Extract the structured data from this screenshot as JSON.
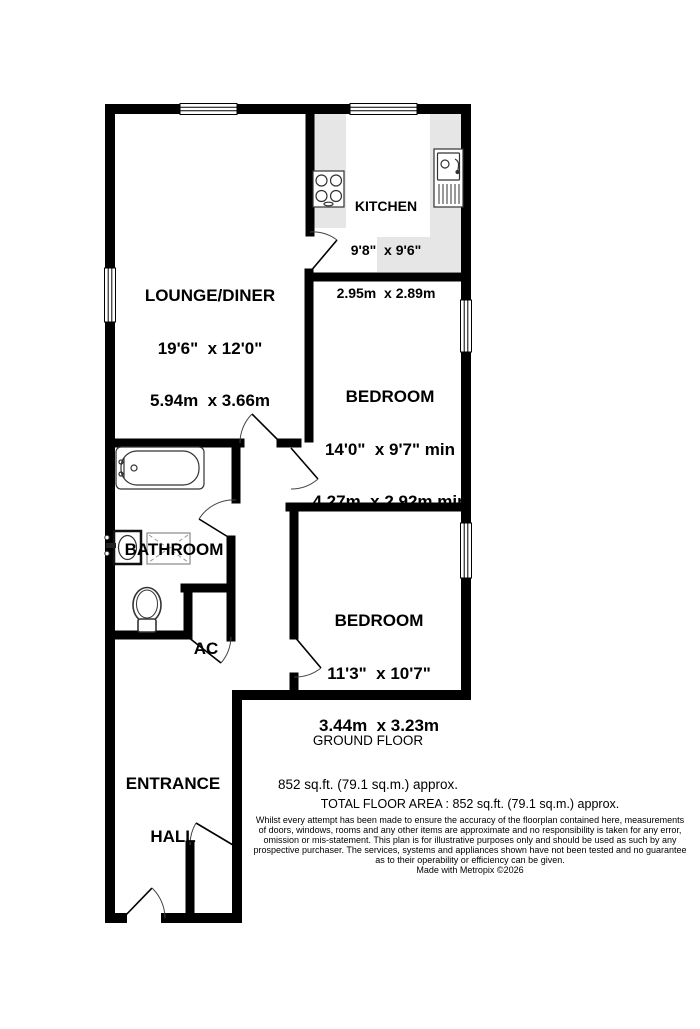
{
  "rooms": {
    "kitchen": {
      "name": "KITCHEN",
      "imperial": "9'8\"  x 9'6\"",
      "metric": "2.95m  x 2.89m"
    },
    "lounge_diner": {
      "name": "LOUNGE/DINER",
      "imperial": "19'6\"  x 12'0\"",
      "metric": "5.94m  x 3.66m"
    },
    "bedroom_1": {
      "name": "BEDROOM",
      "imperial": "14'0\"  x 9'7\" min",
      "metric": "4.27m  x 2.92m min"
    },
    "bedroom_2": {
      "name": "BEDROOM",
      "imperial": "11'3\"  x 10'7\"",
      "metric": "3.44m  x 3.23m"
    },
    "bathroom": {
      "name": "BATHROOM"
    },
    "airing_cupboard": {
      "name": "AC"
    },
    "entrance_hall": {
      "name_line1": "ENTRANCE",
      "name_line2": "HALL"
    }
  },
  "floor_summary": {
    "title": "GROUND FLOOR",
    "area": "852 sq.ft. (79.1 sq.m.) approx."
  },
  "footer": {
    "total_area": "TOTAL FLOOR AREA : 852 sq.ft. (79.1 sq.m.) approx.",
    "disclaimer_lines": [
      "Whilst every attempt has been made to ensure the accuracy of the floorplan contained here, measurements",
      "of doors, windows, rooms and any other items are approximate and no responsibility is taken for any error,",
      "omission or mis-statement. This plan is for illustrative purposes only and should be used as such by any",
      "prospective purchaser. The services, systems and appliances shown have not been tested and no guarantee",
      "as to their operability or efficiency can be given."
    ],
    "credit": "Made with Metropix ©2026"
  },
  "fixtures": [
    "hob-icon",
    "sink-drainer-icon",
    "bath-icon",
    "basin-icon",
    "shower-icon",
    "toilet-icon"
  ],
  "colors": {
    "wall": "#000000",
    "counter": "#e6e6e6",
    "fixture_outline": "#333333",
    "background": "#ffffff"
  }
}
